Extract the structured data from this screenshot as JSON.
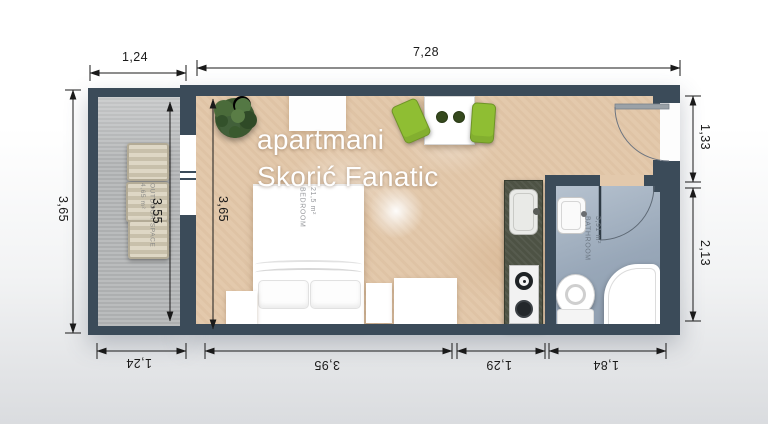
{
  "title": {
    "line1": "apartmani",
    "line2": "Skorić Fanatic"
  },
  "rooms": {
    "bedroom": {
      "name": "BEDROOM",
      "area": "21,5 m²"
    },
    "bathroom": {
      "name": "BATHROOM",
      "area": "3,91 m²"
    },
    "outdoor": {
      "name": "OUTDOOR SPACE",
      "area": "4,65 m²"
    }
  },
  "dimensions": {
    "top_outdoor": "1,24",
    "top_main": "7,28",
    "left_outdoor": "3,65",
    "inner_outdoor": "3,55",
    "inner_bedroom": "3,65",
    "right_upper": "1,33",
    "right_lower": "2,13",
    "bottom_outdoor": "1,24",
    "bottom_bedroom": "3,95",
    "bottom_kitchen": "1,29",
    "bottom_bathroom": "1,84"
  },
  "colors": {
    "wall": "#3b4b59",
    "main_floor": "#e3c9ac",
    "outdoor_floor": "#b6b8b9",
    "bathroom_floor": "#a3b1c1",
    "kitchen_counter": "#4d5244",
    "chair_green": "#8fbe33",
    "dimension_text": "#1a1a1a"
  }
}
